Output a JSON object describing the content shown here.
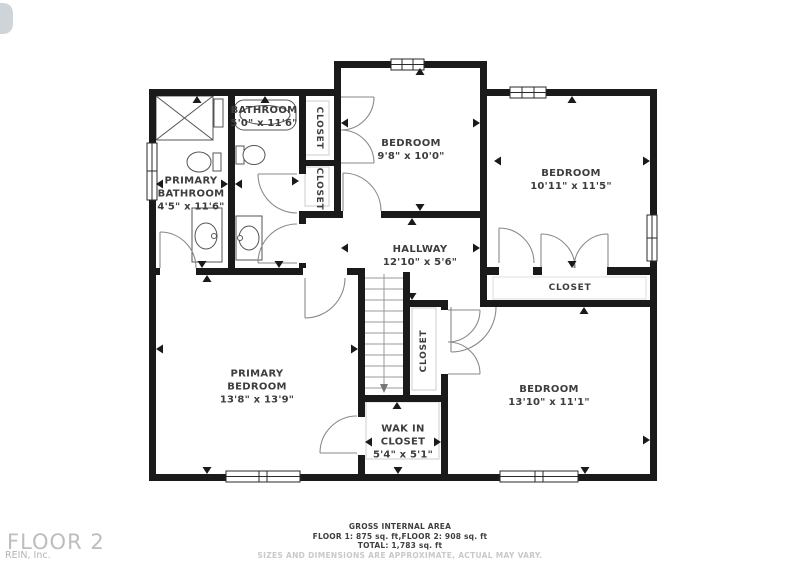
{
  "colors": {
    "wall": "#1a1a1a",
    "room_text": "#3d3d3d",
    "footer_text": "#3f3f3f",
    "muted_text": "#c9c9c9",
    "watermark_text": "#bdbdbd"
  },
  "rooms": {
    "primary_bathroom": {
      "name": "PRIMARY BATHROOM",
      "dims": "4'5\" x 11'6\""
    },
    "bathroom": {
      "name": "BATHROOM",
      "dims": "5'0\" x 11'6\""
    },
    "bedroom_top": {
      "name": "BEDROOM",
      "dims": "9'8\" x 10'0\""
    },
    "bedroom_right": {
      "name": "BEDROOM",
      "dims": "10'11\" x 11'5\""
    },
    "hallway": {
      "name": "HALLWAY",
      "dims": "12'10\" x 5'6\""
    },
    "primary_bedroom": {
      "name": "PRIMARY BEDROOM",
      "dims": "13'8\" x 13'9\""
    },
    "bedroom_bottom": {
      "name": "BEDROOM",
      "dims": "13'10\" x 11'1\""
    },
    "walk_in_closet": {
      "name": "WAK IN CLOSET",
      "dims": "5'4\" x 5'1\""
    }
  },
  "closets": {
    "upper": "CLOSET",
    "lower": "CLOSET",
    "bedroom_strip": "CLOSET",
    "stairs_side": "CLOSET"
  },
  "footer": {
    "title": "GROSS INTERNAL AREA",
    "floors": "FLOOR 1: 875 sq. ft,FLOOR 2: 908 sq. ft",
    "total": "TOTAL: 1,783 sq. ft",
    "disclaimer": "SIZES AND DIMENSIONS ARE APPROXIMATE, ACTUAL MAY VARY."
  },
  "watermark": {
    "floor": "FLOOR 2",
    "brand": "REIN, Inc."
  }
}
